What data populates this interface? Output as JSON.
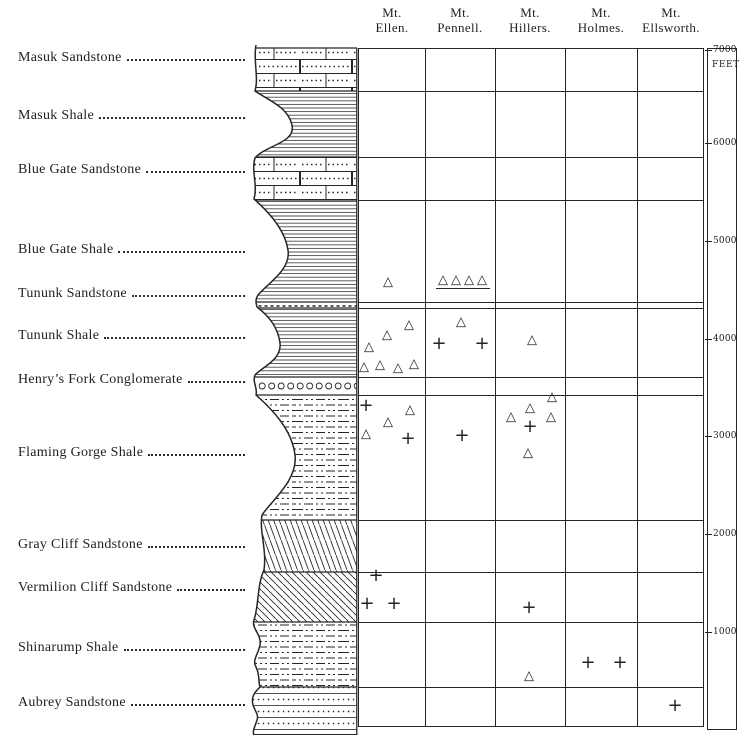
{
  "figure": {
    "background": "#fffffe",
    "ink": "#262626"
  },
  "columns": [
    {
      "line1": "Mt.",
      "line2": "Ellen.",
      "center_x": 392
    },
    {
      "line1": "Mt.",
      "line2": "Pennell.",
      "center_x": 460
    },
    {
      "line1": "Mt.",
      "line2": "Hillers.",
      "center_x": 530
    },
    {
      "line1": "Mt.",
      "line2": "Holmes.",
      "center_x": 601
    },
    {
      "line1": "Mt.",
      "line2": "Ellsworth.",
      "center_x": 671
    }
  ],
  "grid": {
    "left": 358,
    "top": 48,
    "right": 704,
    "bottom": 727,
    "column_dividers": [
      425,
      495,
      565,
      637
    ],
    "row_lines": [
      91,
      157,
      200,
      302,
      308,
      377,
      395,
      520,
      572,
      622,
      687
    ]
  },
  "scale": {
    "unit": "FEET",
    "box": {
      "left": 707,
      "top": 48,
      "width": 30,
      "height": 682
    },
    "ticks": [
      {
        "label": "7000",
        "y": 50
      },
      {
        "label": "6000",
        "y": 143
      },
      {
        "label": "5000",
        "y": 241
      },
      {
        "label": "4000",
        "y": 339
      },
      {
        "label": "3000",
        "y": 436
      },
      {
        "label": "2000",
        "y": 534
      },
      {
        "label": "1000",
        "y": 632
      }
    ]
  },
  "formations": [
    {
      "label": "Masuk Sandstone",
      "label_y": 60,
      "band": [
        48,
        91
      ],
      "pattern": "brick"
    },
    {
      "label": "Masuk Shale",
      "label_y": 118,
      "band": [
        91,
        157
      ],
      "pattern": "hlines"
    },
    {
      "label": "Blue Gate Sandstone",
      "label_y": 172,
      "band": [
        157,
        200
      ],
      "pattern": "brick"
    },
    {
      "label": "Blue Gate Shale",
      "label_y": 252,
      "band": [
        200,
        302
      ],
      "pattern": "hlines"
    },
    {
      "label": "Tununk Sandstone",
      "label_y": 296,
      "band": [
        302,
        308
      ],
      "pattern": "dotline"
    },
    {
      "label": "Tununk Shale",
      "label_y": 338,
      "band": [
        308,
        377
      ],
      "pattern": "hlines"
    },
    {
      "label": "Henry’s Fork Conglomerate",
      "label_y": 382,
      "band": [
        377,
        395
      ],
      "pattern": "pebbles"
    },
    {
      "label": "Flaming Gorge Shale",
      "label_y": 455,
      "band": [
        395,
        520
      ],
      "pattern": "dashdot"
    },
    {
      "label": "Gray Cliff Sandstone",
      "label_y": 547,
      "band": [
        520,
        572
      ],
      "pattern": "hatchsteep"
    },
    {
      "label": "Vermilion Cliff Sandstone",
      "label_y": 590,
      "band": [
        572,
        622
      ],
      "pattern": "hatch45"
    },
    {
      "label": "Shinarump Shale",
      "label_y": 650,
      "band": [
        622,
        687
      ],
      "pattern": "dashdot"
    },
    {
      "label": "Aubrey Sandstone",
      "label_y": 705,
      "band": [
        687,
        735
      ],
      "pattern": "dotrows"
    }
  ],
  "chart_data": {
    "type": "scatter",
    "title": "",
    "description": "Stratigraphic section of the Henry Mountains region: formations on the left with lithologic column; triangle and cross occurrence markers plotted by formation under each mountain; depth scale in feet at right.",
    "x_categories": [
      "Mt. Ellen.",
      "Mt. Pennell.",
      "Mt. Hillers.",
      "Mt. Holmes.",
      "Mt. Ellsworth."
    ],
    "y_axis": {
      "unit": "FEET",
      "ticks": [
        7000,
        6000,
        5000,
        4000,
        3000,
        2000,
        1000
      ]
    },
    "symbols": [
      {
        "mountain": "Mt. Ellen.",
        "formation": "Tununk Sandstone",
        "marker": "triangle",
        "x": 388,
        "y": 282
      },
      {
        "mountain": "Mt. Ellen.",
        "formation": "Tununk Shale",
        "marker": "triangle",
        "x": 409,
        "y": 325
      },
      {
        "mountain": "Mt. Ellen.",
        "formation": "Tununk Shale",
        "marker": "triangle",
        "x": 387,
        "y": 335
      },
      {
        "mountain": "Mt. Ellen.",
        "formation": "Tununk Shale",
        "marker": "triangle",
        "x": 369,
        "y": 347
      },
      {
        "mountain": "Mt. Ellen.",
        "formation": "Tununk Shale",
        "marker": "triangle",
        "x": 364,
        "y": 367
      },
      {
        "mountain": "Mt. Ellen.",
        "formation": "Tununk Shale",
        "marker": "triangle",
        "x": 380,
        "y": 365
      },
      {
        "mountain": "Mt. Ellen.",
        "formation": "Tununk Shale",
        "marker": "triangle",
        "x": 398,
        "y": 368
      },
      {
        "mountain": "Mt. Ellen.",
        "formation": "Tununk Shale",
        "marker": "triangle",
        "x": 414,
        "y": 364
      },
      {
        "mountain": "Mt. Ellen.",
        "formation": "Flaming Gorge Shale",
        "marker": "cross",
        "x": 366,
        "y": 406
      },
      {
        "mountain": "Mt. Ellen.",
        "formation": "Flaming Gorge Shale",
        "marker": "triangle",
        "x": 410,
        "y": 410
      },
      {
        "mountain": "Mt. Ellen.",
        "formation": "Flaming Gorge Shale",
        "marker": "triangle",
        "x": 388,
        "y": 422
      },
      {
        "mountain": "Mt. Ellen.",
        "formation": "Flaming Gorge Shale",
        "marker": "triangle",
        "x": 366,
        "y": 434
      },
      {
        "mountain": "Mt. Ellen.",
        "formation": "Flaming Gorge Shale",
        "marker": "cross",
        "x": 408,
        "y": 439
      },
      {
        "mountain": "Mt. Ellen.",
        "formation": "Vermilion Cliff Sandstone",
        "marker": "cross",
        "x": 376,
        "y": 576
      },
      {
        "mountain": "Mt. Ellen.",
        "formation": "Vermilion Cliff Sandstone",
        "marker": "cross",
        "x": 367,
        "y": 604
      },
      {
        "mountain": "Mt. Ellen.",
        "formation": "Vermilion Cliff Sandstone",
        "marker": "cross",
        "x": 394,
        "y": 604
      },
      {
        "mountain": "Mt. Pennell.",
        "formation": "Tununk Sandstone",
        "marker": "triangle",
        "x": 443,
        "y": 280
      },
      {
        "mountain": "Mt. Pennell.",
        "formation": "Tununk Sandstone",
        "marker": "triangle",
        "x": 456,
        "y": 280
      },
      {
        "mountain": "Mt. Pennell.",
        "formation": "Tununk Sandstone",
        "marker": "triangle",
        "x": 469,
        "y": 280
      },
      {
        "mountain": "Mt. Pennell.",
        "formation": "Tununk Sandstone",
        "marker": "triangle",
        "x": 482,
        "y": 280
      },
      {
        "mountain": "Mt. Pennell.",
        "formation": "Tununk Shale",
        "marker": "triangle",
        "x": 461,
        "y": 322
      },
      {
        "mountain": "Mt. Pennell.",
        "formation": "Tununk Shale",
        "marker": "cross",
        "x": 439,
        "y": 344
      },
      {
        "mountain": "Mt. Pennell.",
        "formation": "Tununk Shale",
        "marker": "cross",
        "x": 482,
        "y": 344
      },
      {
        "mountain": "Mt. Pennell.",
        "formation": "Flaming Gorge Shale",
        "marker": "cross",
        "x": 462,
        "y": 436
      },
      {
        "mountain": "Mt. Hillers.",
        "formation": "Tununk Shale",
        "marker": "triangle",
        "x": 532,
        "y": 340
      },
      {
        "mountain": "Mt. Hillers.",
        "formation": "Flaming Gorge Shale",
        "marker": "triangle",
        "x": 552,
        "y": 397
      },
      {
        "mountain": "Mt. Hillers.",
        "formation": "Flaming Gorge Shale",
        "marker": "triangle",
        "x": 530,
        "y": 408
      },
      {
        "mountain": "Mt. Hillers.",
        "formation": "Flaming Gorge Shale",
        "marker": "triangle",
        "x": 511,
        "y": 417
      },
      {
        "mountain": "Mt. Hillers.",
        "formation": "Flaming Gorge Shale",
        "marker": "triangle",
        "x": 551,
        "y": 417
      },
      {
        "mountain": "Mt. Hillers.",
        "formation": "Flaming Gorge Shale",
        "marker": "cross",
        "x": 530,
        "y": 427
      },
      {
        "mountain": "Mt. Hillers.",
        "formation": "Flaming Gorge Shale",
        "marker": "triangle",
        "x": 528,
        "y": 453
      },
      {
        "mountain": "Mt. Hillers.",
        "formation": "Vermilion Cliff Sandstone",
        "marker": "cross",
        "x": 529,
        "y": 608
      },
      {
        "mountain": "Mt. Hillers.",
        "formation": "Shinarump Shale",
        "marker": "triangle",
        "x": 529,
        "y": 676
      },
      {
        "mountain": "Mt. Holmes.",
        "formation": "Shinarump Shale",
        "marker": "cross",
        "x": 588,
        "y": 663
      },
      {
        "mountain": "Mt. Holmes.",
        "formation": "Shinarump Shale",
        "marker": "cross",
        "x": 620,
        "y": 663
      },
      {
        "mountain": "Mt. Ellsworth.",
        "formation": "Aubrey Sandstone",
        "marker": "cross",
        "x": 675,
        "y": 706
      }
    ],
    "annotations": [
      {
        "type": "underline",
        "x1": 436,
        "x2": 490,
        "y": 288,
        "note": "baseline under Mt. Pennell triangle group"
      }
    ]
  }
}
